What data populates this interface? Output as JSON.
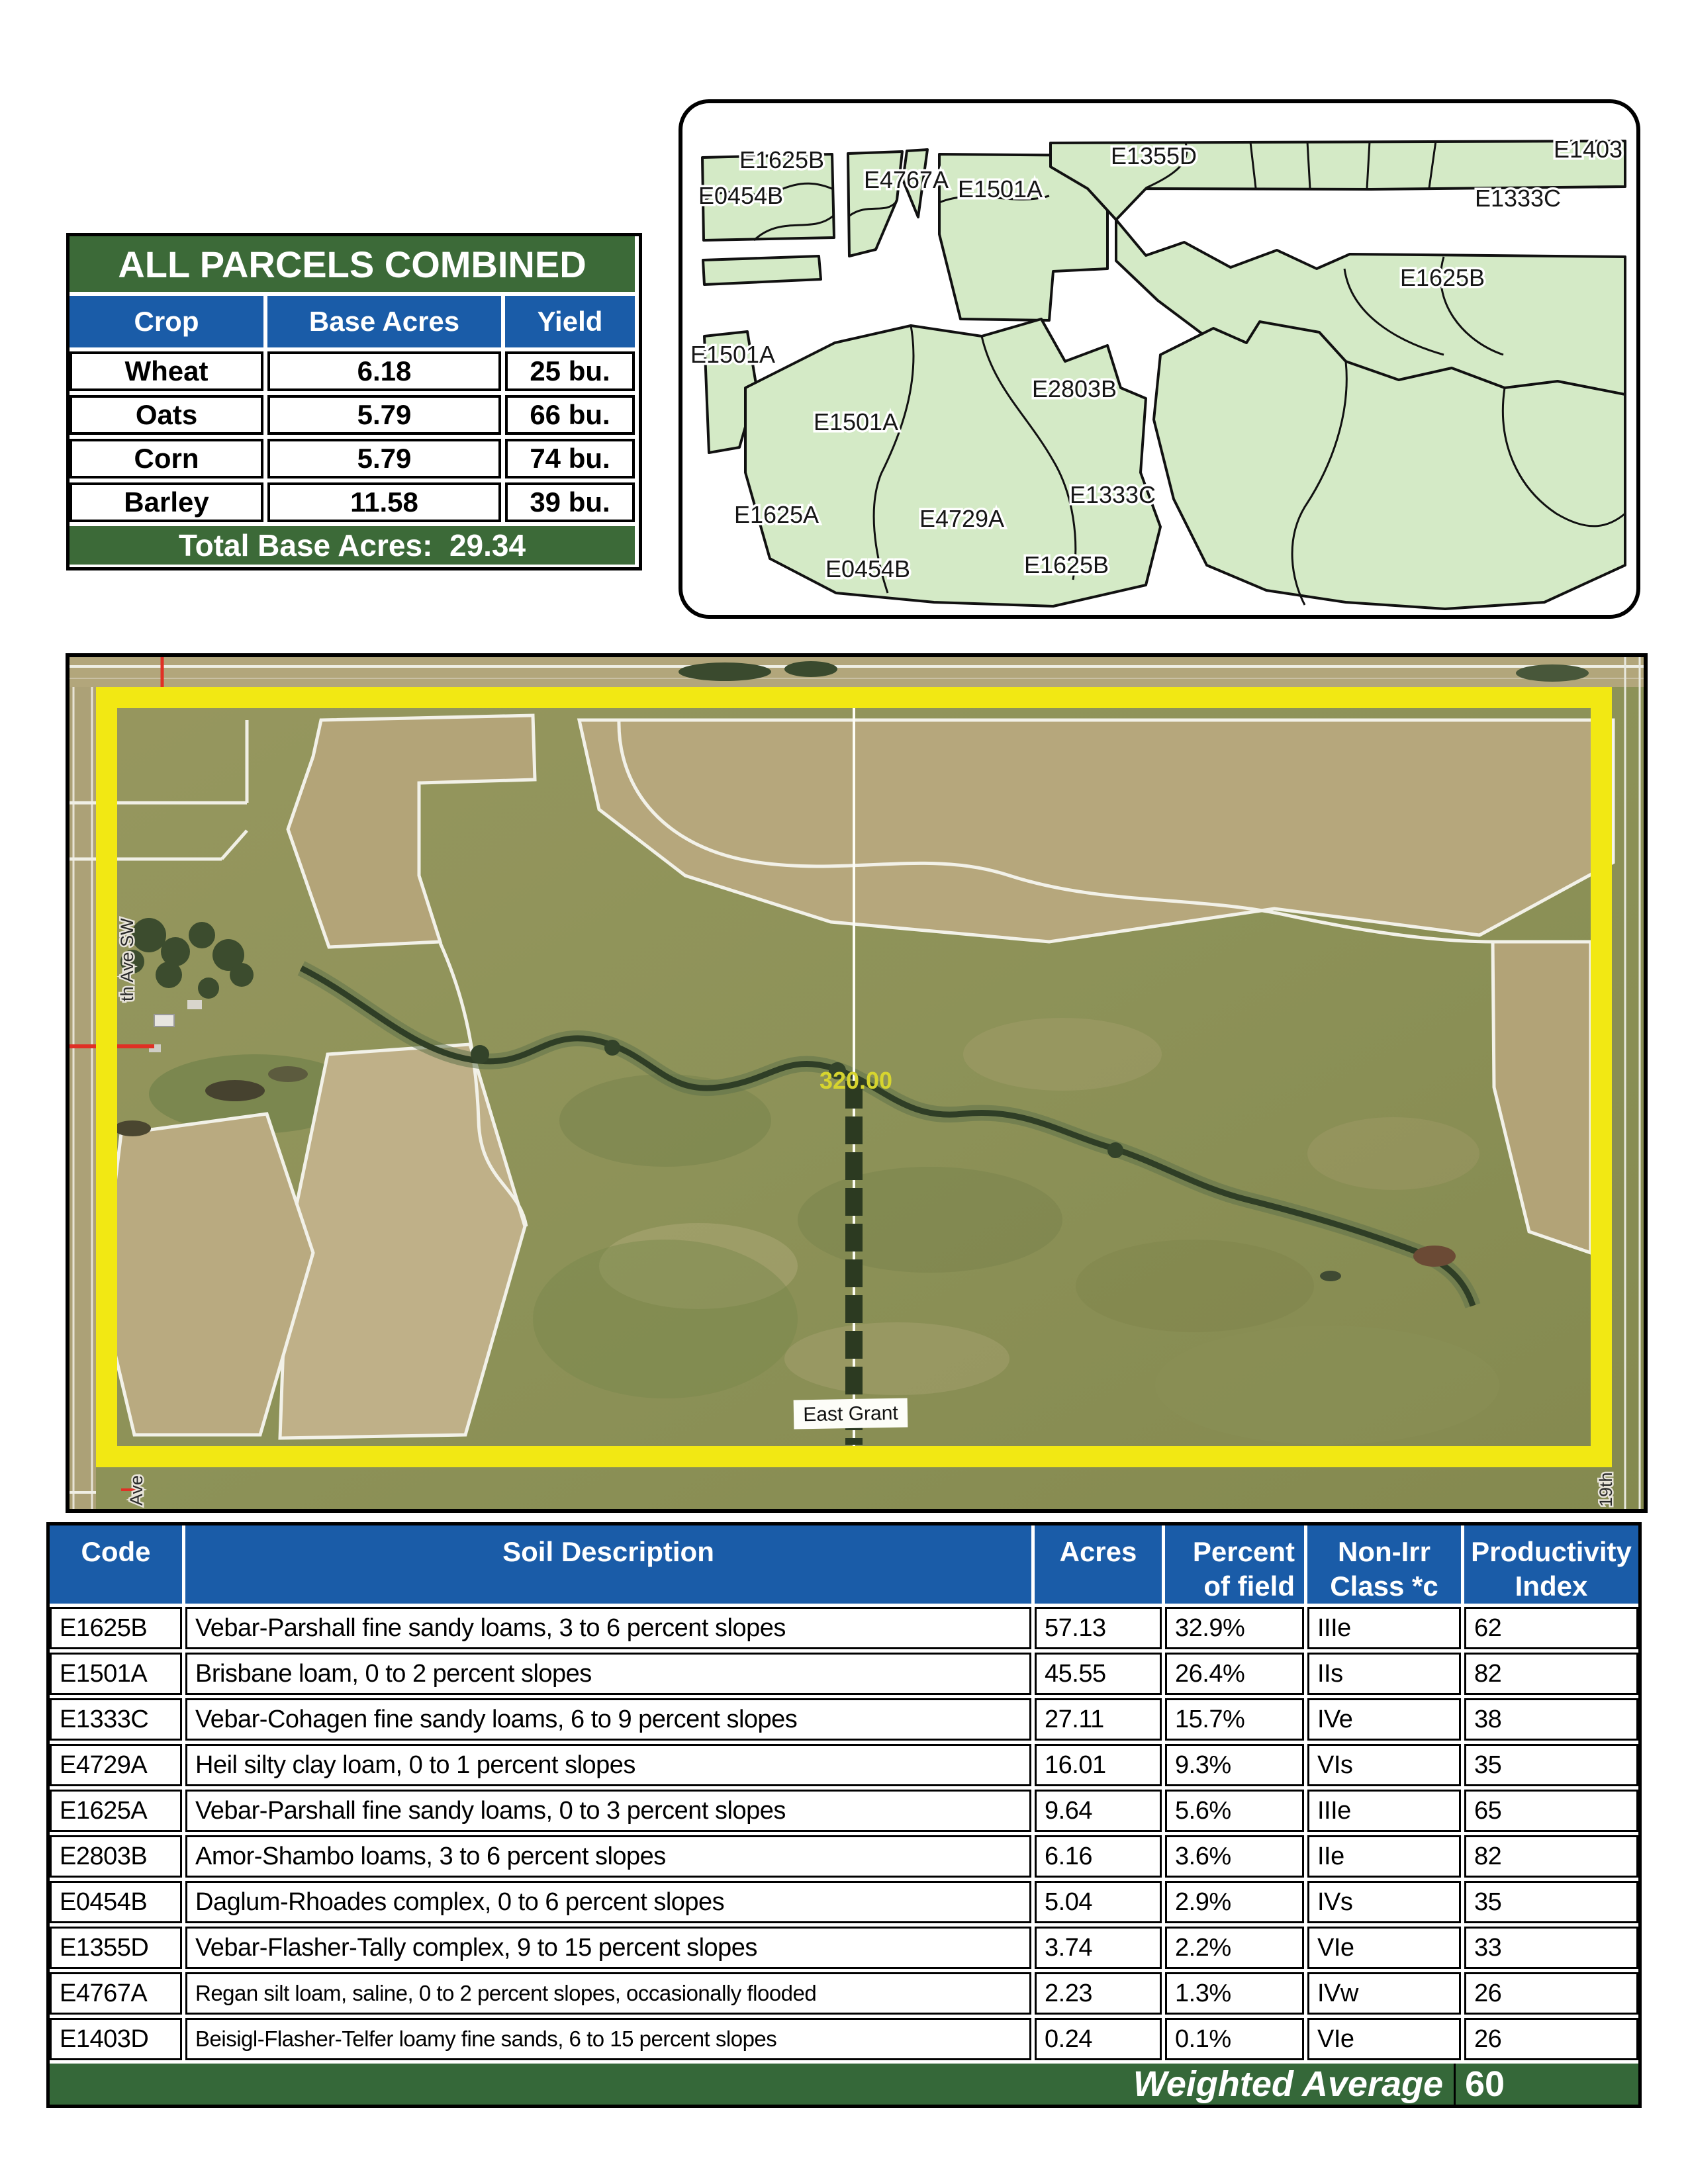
{
  "crop_table": {
    "title": "ALL PARCELS COMBINED",
    "columns": [
      "Crop",
      "Base Acres",
      "Yield"
    ],
    "rows": [
      {
        "crop": "Wheat",
        "base_acres": "6.18",
        "yield": "25 bu."
      },
      {
        "crop": "Oats",
        "base_acres": "5.79",
        "yield": "66 bu."
      },
      {
        "crop": "Corn",
        "base_acres": "5.79",
        "yield": "74 bu."
      },
      {
        "crop": "Barley",
        "base_acres": "11.58",
        "yield": "39 bu."
      }
    ],
    "footer": "Total Base Acres:  29.34"
  },
  "soil_map": {
    "labels": [
      "E1625B",
      "E0454B",
      "E4767A",
      "E1501A",
      "E1355D",
      "E1403",
      "E1333C",
      "E1625B",
      "E1501A",
      "E1501A",
      "E2803B",
      "E1333C",
      "E1625A",
      "E4729A",
      "E0454B",
      "E1625B"
    ],
    "parcel_fill": "#d4eac6"
  },
  "aerial": {
    "acreage_label": "320.00",
    "township_label": "East Grant",
    "left_road_label": "th Ave SW",
    "left_road_fragment": "Ave",
    "right_road_label": "19th",
    "border_color": "#f2e813"
  },
  "soil_table": {
    "headers": {
      "code": {
        "l1": "Code"
      },
      "description": {
        "l1": "Soil Description"
      },
      "acres": {
        "l1": "Acres"
      },
      "percent": {
        "l1": "Percent",
        "l2": "of field"
      },
      "nonirr": {
        "l1": "Non-Irr",
        "l2": "Class *c"
      },
      "productivity": {
        "l1": "Productivity",
        "l2": "Index"
      }
    },
    "rows": [
      {
        "code": "E1625B",
        "desc": "Vebar-Parshall fine sandy loams, 3 to 6 percent slopes",
        "acres": "57.13",
        "pct": "32.9%",
        "cls": "IIIe",
        "pi": "62"
      },
      {
        "code": "E1501A",
        "desc": "Brisbane loam, 0 to 2 percent slopes",
        "acres": "45.55",
        "pct": "26.4%",
        "cls": "IIs",
        "pi": "82"
      },
      {
        "code": "E1333C",
        "desc": "Vebar-Cohagen fine sandy loams, 6 to 9 percent slopes",
        "acres": "27.11",
        "pct": "15.7%",
        "cls": "IVe",
        "pi": "38"
      },
      {
        "code": "E4729A",
        "desc": "Heil silty clay loam, 0 to 1 percent slopes",
        "acres": "16.01",
        "pct": "9.3%",
        "cls": "VIs",
        "pi": "35"
      },
      {
        "code": "E1625A",
        "desc": "Vebar-Parshall fine sandy loams, 0 to 3 percent slopes",
        "acres": "9.64",
        "pct": "5.6%",
        "cls": "IIIe",
        "pi": "65"
      },
      {
        "code": "E2803B",
        "desc": "Amor-Shambo loams, 3 to 6 percent slopes",
        "acres": "6.16",
        "pct": "3.6%",
        "cls": "IIe",
        "pi": "82"
      },
      {
        "code": "E0454B",
        "desc": "Daglum-Rhoades complex, 0 to 6 percent slopes",
        "acres": "5.04",
        "pct": "2.9%",
        "cls": "IVs",
        "pi": "35"
      },
      {
        "code": "E1355D",
        "desc": "Vebar-Flasher-Tally complex, 9 to 15 percent slopes",
        "acres": "3.74",
        "pct": "2.2%",
        "cls": "VIe",
        "pi": "33"
      },
      {
        "code": "E4767A",
        "desc": "Regan silt loam, saline, 0 to 2 percent slopes, occasionally flooded",
        "acres": "2.23",
        "pct": "1.3%",
        "cls": "IVw",
        "pi": "26"
      },
      {
        "code": "E1403D",
        "desc": "Beisigl-Flasher-Telfer loamy fine sands, 6 to 15 percent slopes",
        "acres": "0.24",
        "pct": "0.1%",
        "cls": "VIe",
        "pi": "26"
      }
    ],
    "footer_label": "Weighted Average",
    "footer_value": "60"
  },
  "colors": {
    "green": "#3c6a38",
    "blue": "#1a5ca8",
    "yellow_border": "#f2e813"
  }
}
